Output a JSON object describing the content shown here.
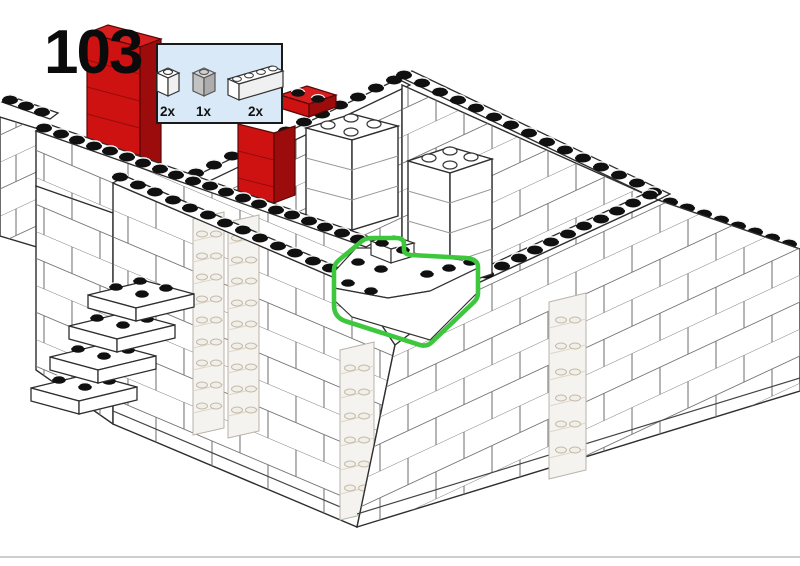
{
  "step": {
    "number": "103"
  },
  "parts_callout": {
    "parts": [
      {
        "qty": "2x",
        "icon": "brick-1x1-white-icon",
        "color": "#ffffff"
      },
      {
        "qty": "1x",
        "icon": "brick-1x1-light-gray-icon",
        "color": "#c9c9c9"
      },
      {
        "qty": "2x",
        "icon": "brick-1x4-white-icon",
        "color": "#ffffff"
      }
    ],
    "background_color": "#d9e9f7",
    "border_color": "#1a1a1a"
  },
  "highlight": {
    "color": "#3dc73d",
    "purpose": "placement-of-new-bricks"
  },
  "model_colors": {
    "brick_white": "#ffffff",
    "outline": "#2e2e2e",
    "red_front": "#ce1111",
    "red_side": "#9c0c0c",
    "red_top": "#d81f1f",
    "stud": "#101010",
    "transparent_tint": "#f5f3ef"
  },
  "page": {
    "background": "#ffffff",
    "footer_divider_color": "#cdcdcd"
  }
}
